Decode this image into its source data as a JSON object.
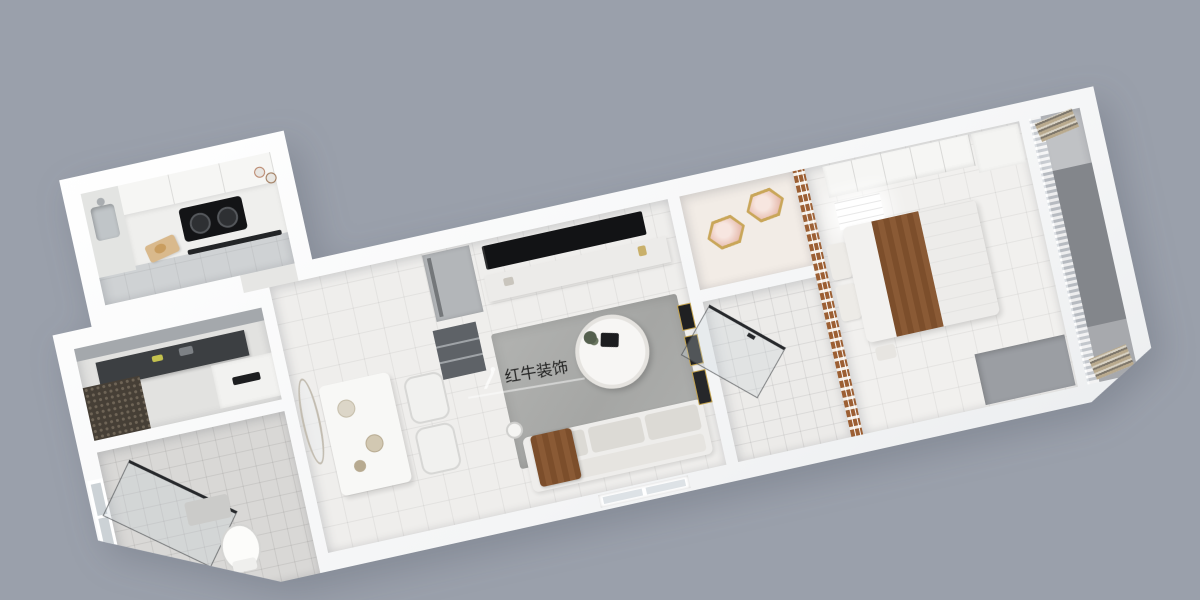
{
  "scene": {
    "description": "3D overhead cutaway render of a long narrow apartment floorplan, tilted on a plain gray backdrop",
    "background_color": "#9aa0ab",
    "watermark": {
      "brand": "红牛装饰",
      "logo": "running-figure",
      "color": "#ffffff"
    }
  },
  "palette": {
    "background": "#9aa0ab",
    "walls": "#fafbfb",
    "floor_tile": "#efeeec",
    "kitchen_floor": "#cfd2d4",
    "rug": "#adaeac",
    "tv_black": "#121315",
    "wood_accent": "#9c5f33",
    "bed_blanket": "#7c4e2b",
    "dark_desk": "#3c3f42",
    "balcony_mat": "#83868b",
    "lamp_gold": "#c9a659"
  },
  "rooms": [
    {
      "id": "kitchen",
      "label": "kitchen",
      "furniture": [
        "upper-cabinets",
        "counter",
        "sink",
        "cooktop",
        "oven-handle",
        "cutting-board",
        "cups"
      ]
    },
    {
      "id": "entry-nook",
      "label": "entry work nook",
      "furniture": [
        "ceiling-beam",
        "dark-desk",
        "rattan-cabinet",
        "white-cabinet"
      ]
    },
    {
      "id": "bathroom-1",
      "label": "bathroom with shower",
      "furniture": [
        "window",
        "shower-glass",
        "toilet",
        "mat"
      ]
    },
    {
      "id": "dining",
      "label": "dining area",
      "furniture": [
        "oval-mirror",
        "dining-table",
        "chairs",
        "fridge",
        "open-shelf"
      ]
    },
    {
      "id": "living",
      "label": "living room",
      "furniture": [
        "tv",
        "tv-console",
        "rug",
        "round-coffee-table",
        "sofa",
        "brown-throw",
        "floor-lamp",
        "window",
        "picture-frames"
      ]
    },
    {
      "id": "study",
      "label": "small room with ceiling lamps",
      "furniture": [
        "flower-lamp-1",
        "flower-lamp-2"
      ]
    },
    {
      "id": "bathroom-2",
      "label": "tiled bathroom",
      "furniture": [
        "glass-door"
      ]
    },
    {
      "id": "bedroom",
      "label": "bedroom",
      "furniture": [
        "lattice-accent-wall",
        "wardrobe",
        "ceiling-light-panel",
        "bed",
        "pillows",
        "brown-blanket",
        "desk"
      ]
    },
    {
      "id": "balcony",
      "label": "balcony",
      "furniture": [
        "sheer-curtain",
        "floor-mats",
        "fringed-rolls"
      ]
    }
  ]
}
